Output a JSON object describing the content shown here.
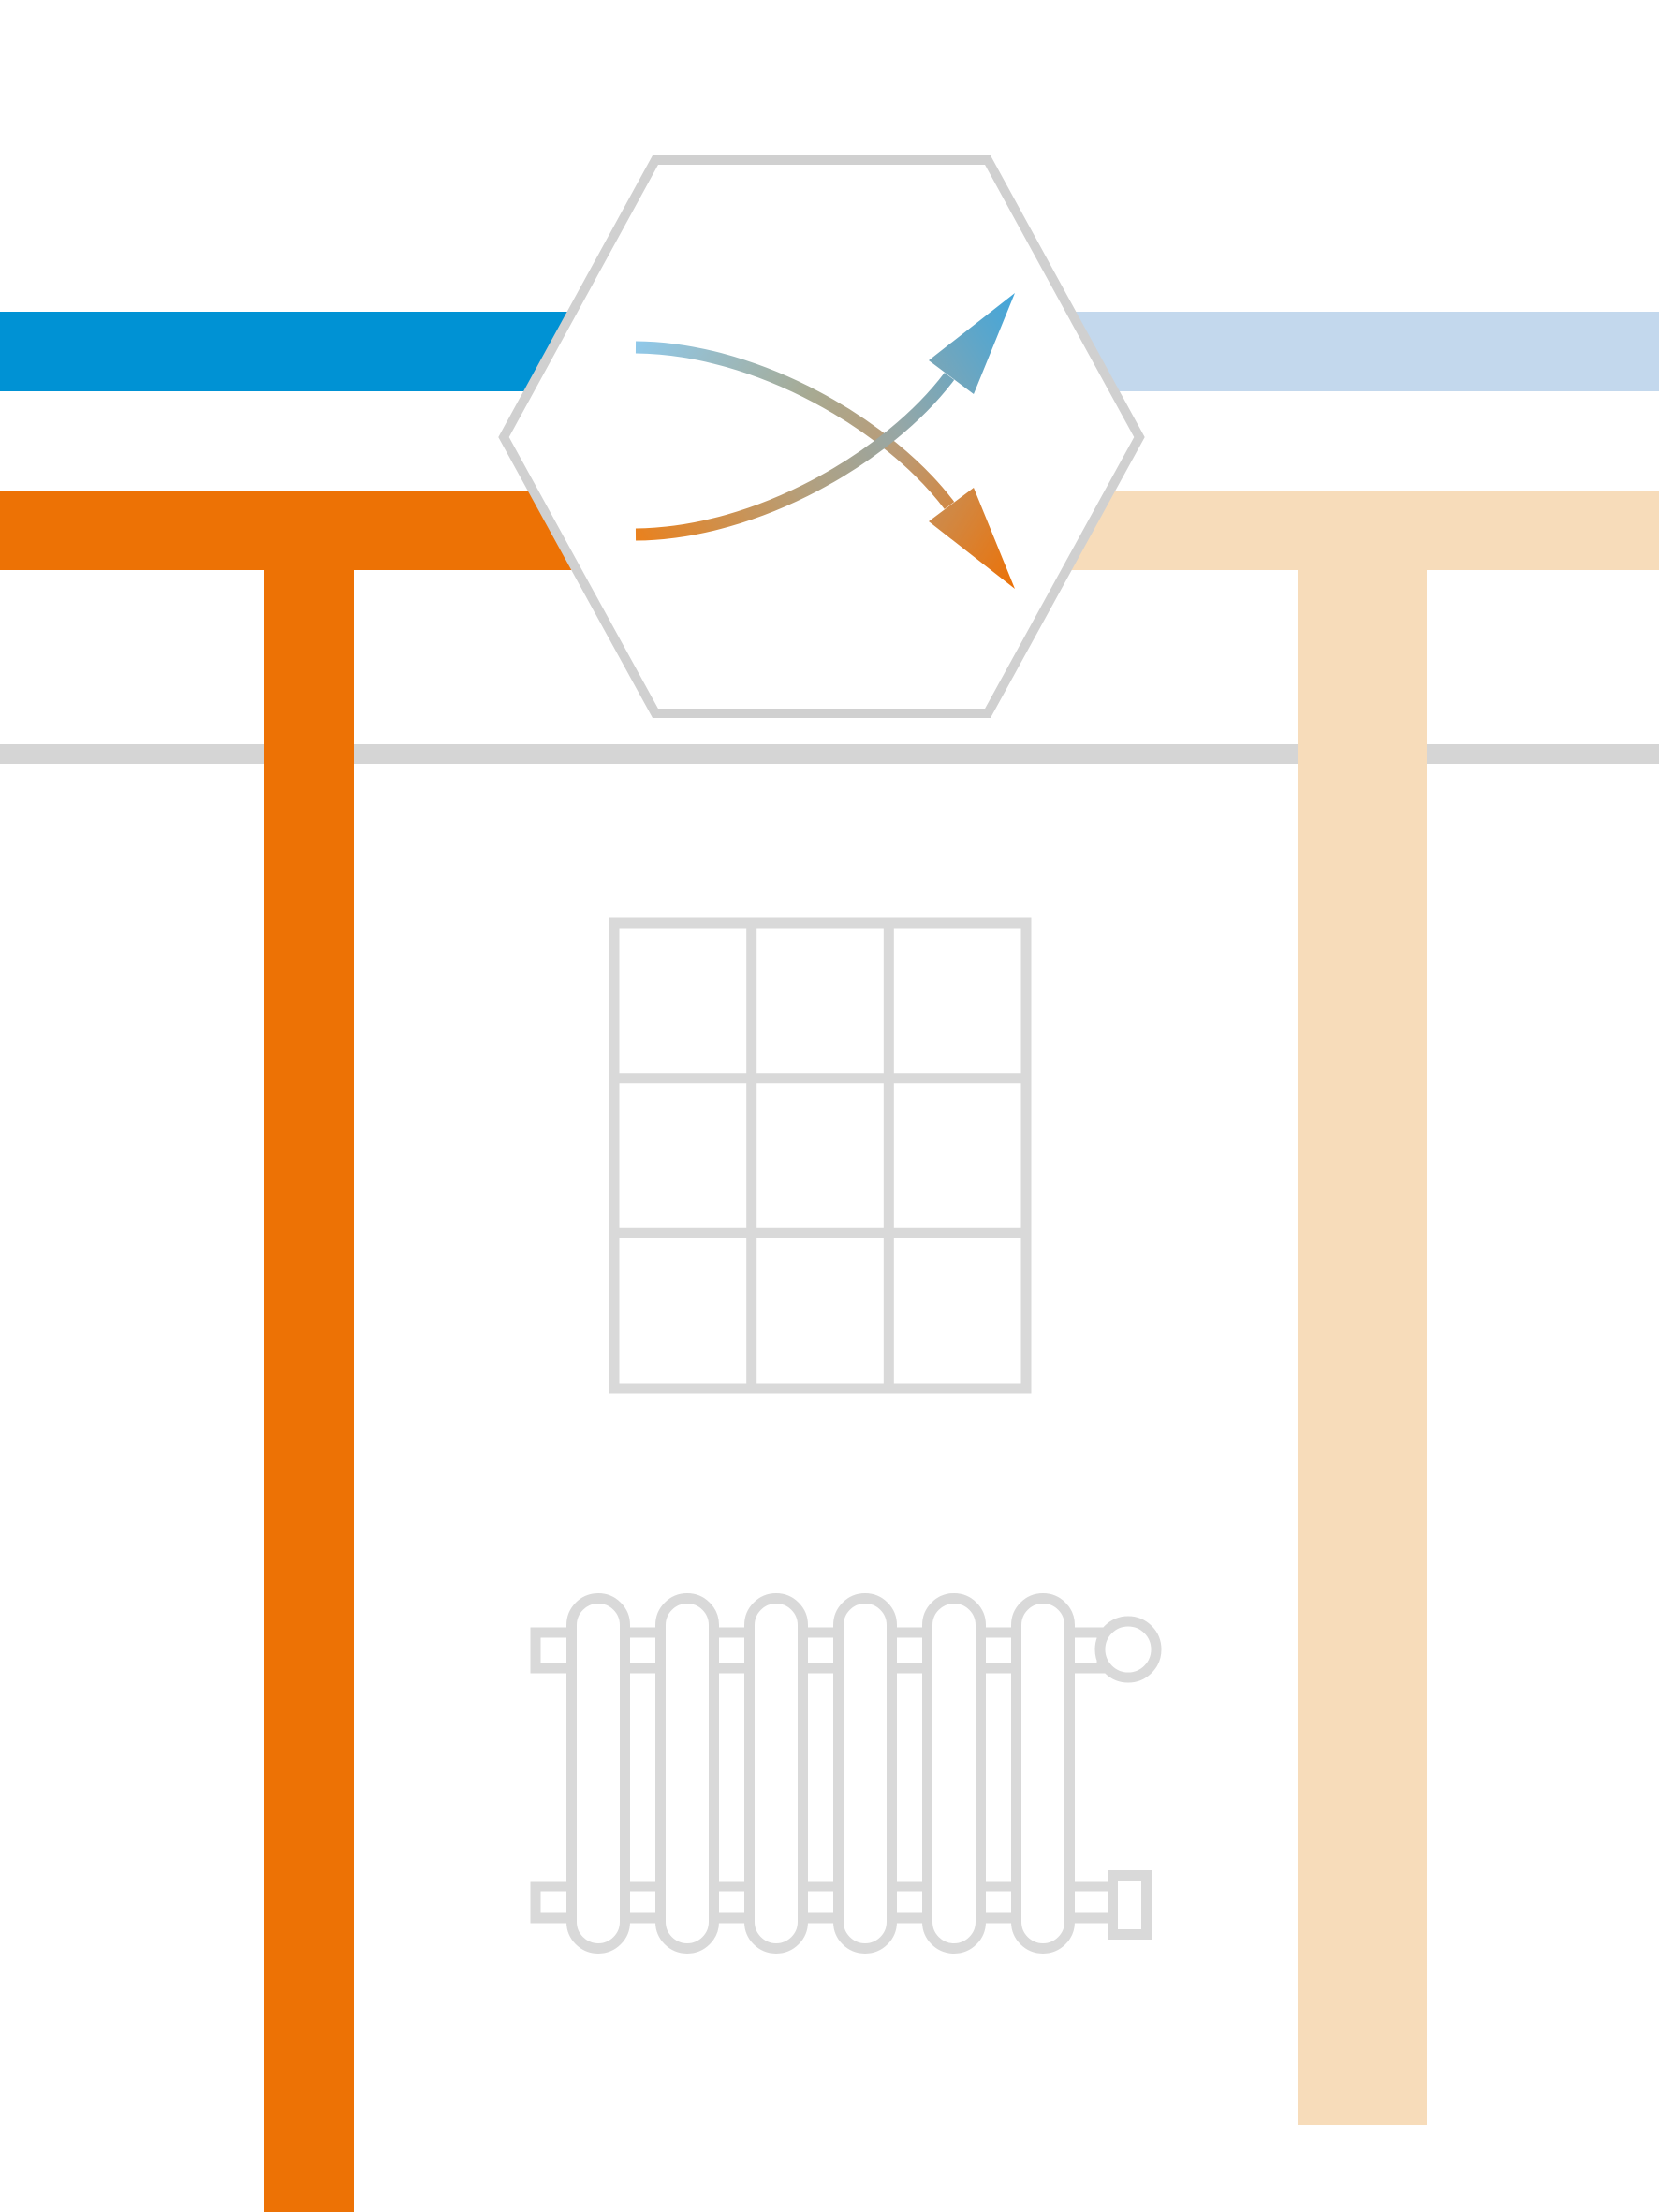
{
  "illustration": {
    "name": "district-heating-heat-exchanger-diagram",
    "icons": [
      {
        "name": "heat-exchanger-hexagon-icon",
        "meaning": "heat exchanger unit"
      },
      {
        "name": "warming-flow-arrow-icon",
        "meaning": "flow entering cold (blue) and leaving hot (orange)"
      },
      {
        "name": "cooling-flow-arrow-icon",
        "meaning": "flow entering hot (orange) and leaving cooled (blue)"
      },
      {
        "name": "window-icon",
        "meaning": "building window outline"
      },
      {
        "name": "radiator-icon",
        "meaning": "room radiator outline"
      }
    ],
    "colors": {
      "blue_supply": "#0092d4",
      "blue_return_light": "#c3d8ed",
      "orange_supply": "#ed7205",
      "orange_return_light": "#f7dcba",
      "hexagon_outline": "#d0d0d0",
      "ground_line": "#d5d5d5",
      "structure_outline": "#d9d9d9",
      "white": "#ffffff",
      "warm_grad_0": "#8fc8e9",
      "warm_grad_1": "#a7aa93",
      "warm_grad_2": "#bb9a74",
      "warm_grad_3": "#ec7106",
      "cool_grad_0": "#e9811e",
      "cool_grad_1": "#b2a07f",
      "cool_grad_2": "#96a7a6",
      "cool_grad_3": "#42a6db"
    }
  }
}
